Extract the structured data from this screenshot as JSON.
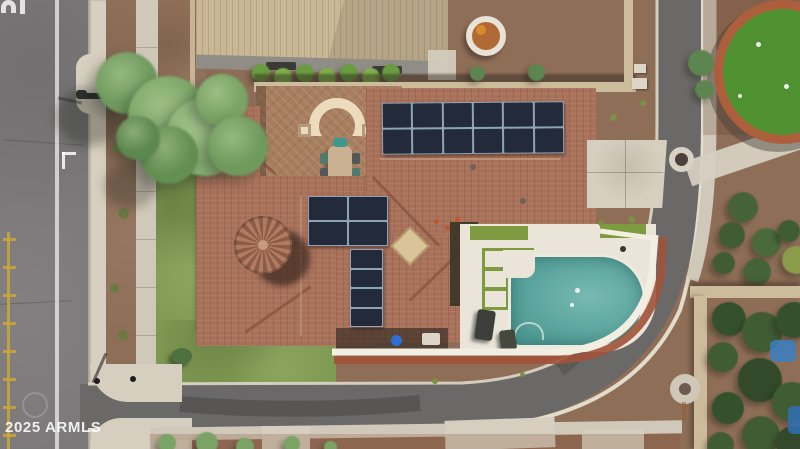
{
  "watermark": {
    "text": "2025 ARMLS"
  },
  "pavement_marking_fragment": "n|",
  "scene": {
    "type": "aerial-real-estate-photo",
    "subject": "corner-lot house with tile roof, rooftop solar, courtyard with arch, pool with white deck, curving street",
    "neighbor_features": [
      "backyard fire pit",
      "circular putting green with brick border"
    ]
  },
  "solar_arrays": {
    "main": {
      "rows": 2,
      "cols": 6
    },
    "small": {
      "rows": 2,
      "cols": 2
    },
    "strip": {
      "rows": 4,
      "cols": 1
    }
  },
  "pool": {
    "lights": 2
  },
  "putting_green": {
    "holes": 3
  },
  "palette": {
    "road": "#7b797a",
    "roadDark": "#6b6967",
    "curb": "#d7cfbf",
    "sidewalk": "#d0c9ba",
    "concrete": "#d6cfc0",
    "gravel": "#8f6e57",
    "gravelDark": "#7a5a45",
    "grass": "#7f9a52",
    "grassShadow": "#55703c",
    "roofTile": "#a8715a",
    "roofTileDark": "#87543f",
    "roofRidge": "#c49a80",
    "neighborRoof": "#c9b795",
    "fascia": "#908d87",
    "wall": "#cdbc9b",
    "paver": "#a87e60",
    "arch": "#ecdcbd",
    "solarCell": "#232a3a",
    "solarFrame": "#8ea3b4",
    "deck": "#eae5d8",
    "pool": "#5fada5",
    "poolDeep": "#4e9a93",
    "turf": "#7f9b3f",
    "green": "#4f9130",
    "brick": "#ad5f3d",
    "tree": "#7aa365",
    "treeDark": "#4f7040",
    "hedge": "#3f5c33",
    "blue": "#3a7fc2",
    "barrel": "#2f6fd0",
    "chair": "#3a9a8f",
    "laneLine": "#e8e6e0",
    "yellow": "#c8a43c",
    "wallCap": "#f2eee2",
    "brickBand": "#a1523a"
  }
}
